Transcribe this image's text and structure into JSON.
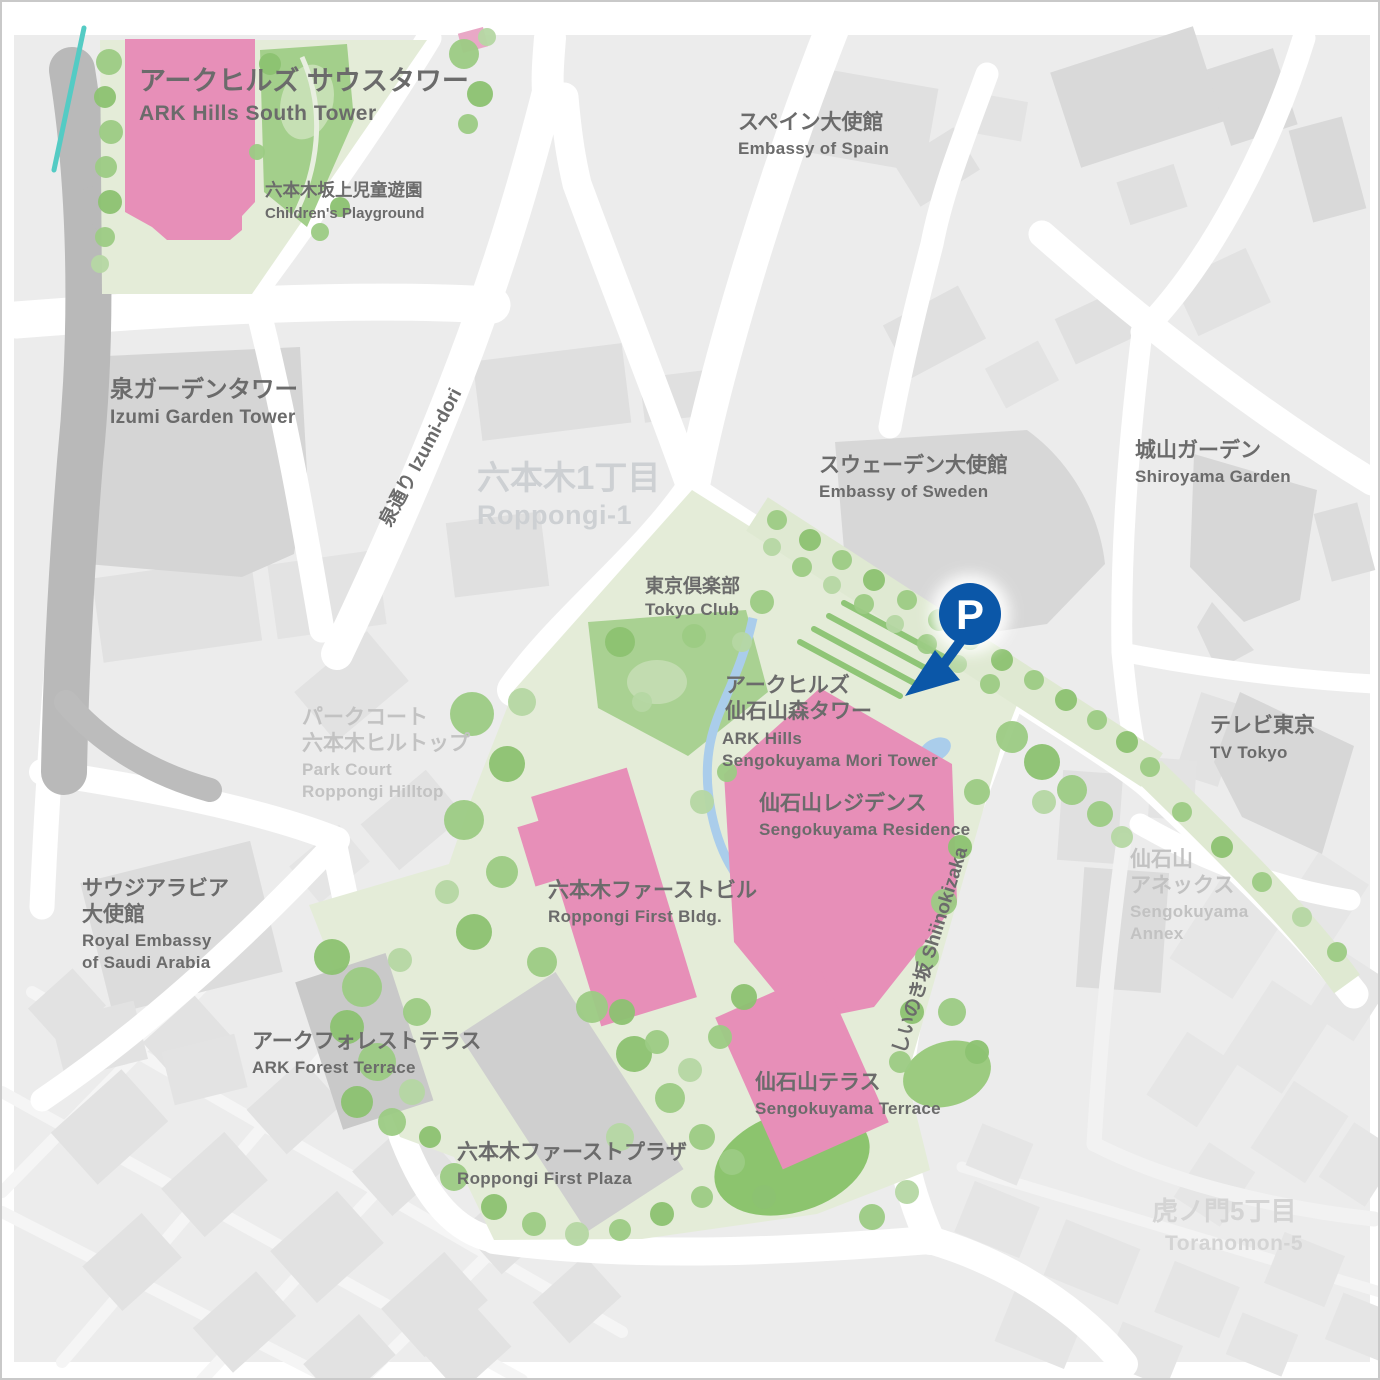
{
  "marker": {
    "parking_label": "P"
  },
  "labels": {
    "ark_south_tower": {
      "jp": "アークヒルズ サウスタワー",
      "en": "ARK Hills South Tower"
    },
    "children_playground": {
      "jp": "六本木坂上児童遊園",
      "en": "Children's Playground"
    },
    "embassy_spain": {
      "jp": "スペイン大使館",
      "en": "Embassy of Spain"
    },
    "izumi_garden_tower": {
      "jp": "泉ガーデンタワー",
      "en": "Izumi Garden Tower"
    },
    "izumi_dori": {
      "text": "泉通り Izumi-dori"
    },
    "roppongi_1": {
      "jp": "六本木1丁目",
      "en": "Roppongi-1"
    },
    "embassy_sweden": {
      "jp": "スウェーデン大使館",
      "en": "Embassy of Sweden"
    },
    "shiroyama_garden": {
      "jp": "城山ガーデン",
      "en": "Shiroyama Garden"
    },
    "tokyo_club": {
      "jp": "東京倶楽部",
      "en": "Tokyo Club"
    },
    "mori_tower": {
      "jp1": "アークヒルズ",
      "jp2": "仙石山森タワー",
      "en1": "ARK Hills",
      "en2": "Sengokuyama Mori Tower"
    },
    "residence": {
      "jp": "仙石山レジデンス",
      "en": "Sengokuyama Residence"
    },
    "park_court": {
      "jp1": "パークコート",
      "jp2": "六本木ヒルトップ",
      "en1": "Park Court",
      "en2": "Roppongi Hilltop"
    },
    "first_bldg": {
      "jp": "六本木ファーストビル",
      "en": "Roppongi First Bldg."
    },
    "saudi_embassy": {
      "jp1": "サウジアラビア",
      "jp2": "大使館",
      "en1": "Royal Embassy",
      "en2": "of Saudi Arabia"
    },
    "tv_tokyo": {
      "jp": "テレビ東京",
      "en": "TV Tokyo"
    },
    "sengokuyama_annex": {
      "jp1": "仙石山",
      "jp2": "アネックス",
      "en1": "Sengokuyama",
      "en2": "Annex"
    },
    "shiinokizaka": {
      "text": "しいのき坂 Shiinokizaka"
    },
    "forest_terrace": {
      "jp": "アークフォレストテラス",
      "en": "ARK Forest Terrace"
    },
    "sengokuyama_terrace": {
      "jp": "仙石山テラス",
      "en": "Sengokuyama Terrace"
    },
    "first_plaza": {
      "jp": "六本木ファーストプラザ",
      "en": "Roppongi First Plaza"
    },
    "toranomon_5": {
      "jp": "虎ノ門5丁目",
      "en": "Toranomon-5"
    }
  },
  "colors": {
    "highlight_pink": "#e78fb8",
    "park_green": "#e4ecd8",
    "tree_green": "#9ccb84",
    "water_blue": "#aacdeb",
    "marker_blue": "#0b57a8",
    "city_gray": "#ececec",
    "road_white": "#ffffff",
    "label_dark": "#6b6b6b",
    "label_light": "#c2c2c2"
  }
}
